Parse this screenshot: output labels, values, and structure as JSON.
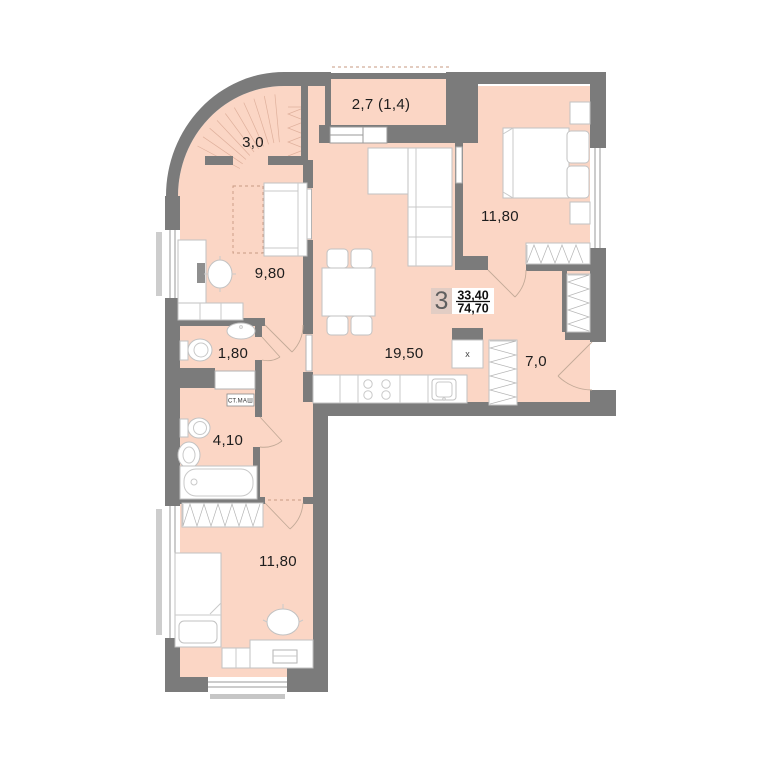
{
  "floorplan": {
    "info_badge": {
      "rooms": "3",
      "living_area": "33,40",
      "total_area": "74,70"
    },
    "room_labels": {
      "corner_loggia": "3,0",
      "balcony": "2,7 (1,4)",
      "bedroom_top": "11,80",
      "room_left": "9,80",
      "kitchen_living": "19,50",
      "wc": "1,80",
      "bathroom": "4,10",
      "hallway": "7,0",
      "bedroom_bottom": "11,80"
    },
    "annotations": {
      "washing_machine": "ст.маш",
      "vent_mark": "x"
    },
    "colors": {
      "floor": "#fbd6c5",
      "wall": "#7b7b7b",
      "hatch": "#dfb09c",
      "furniture_stroke": "#c2c2c2",
      "badge_bg": "#e2cdc4",
      "text": "#1d1d1d"
    }
  }
}
